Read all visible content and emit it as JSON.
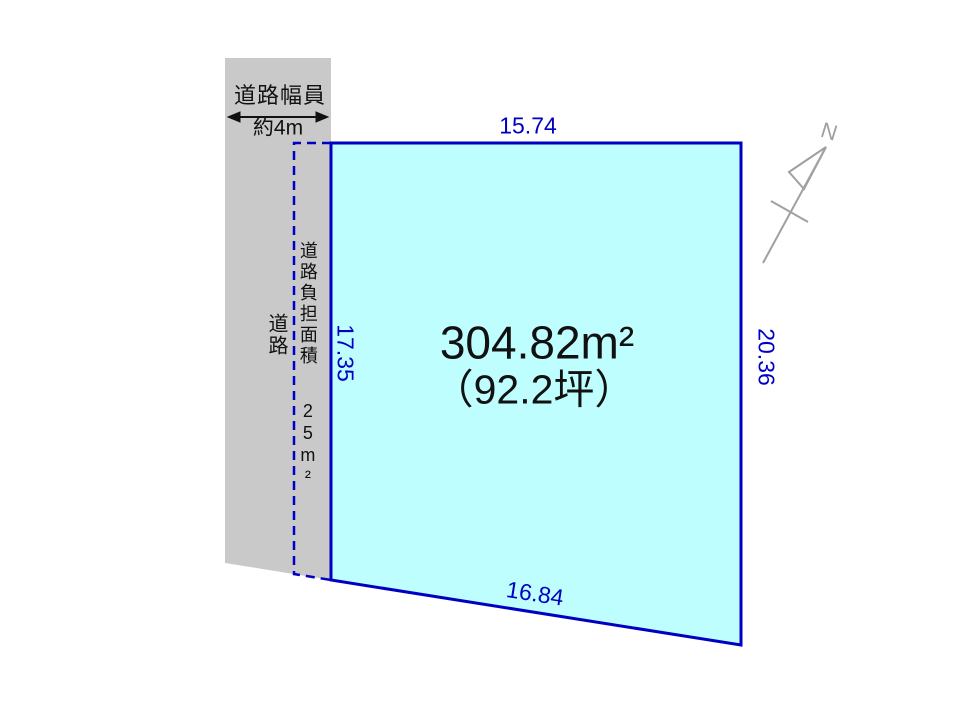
{
  "road": {
    "name_label": "道路",
    "width_title": "道路幅員",
    "width_value": "約4m"
  },
  "burden": {
    "label": "道路負担面積",
    "value": "25m²"
  },
  "plot": {
    "area_sqm": "304.82m²",
    "area_tsubo": "（92.2坪）",
    "dimensions": {
      "top": "15.74",
      "left": "17.35",
      "right": "20.36",
      "bottom": "16.84"
    }
  },
  "compass": {
    "north_label": "N"
  },
  "colors": {
    "plot_fill": "#bffeff",
    "plot_border": "#0000c4",
    "dimension_text": "#0000c4",
    "road_fill": "#c9c9c9",
    "compass_gray": "#a0a0a0",
    "label_text": "#111111"
  }
}
